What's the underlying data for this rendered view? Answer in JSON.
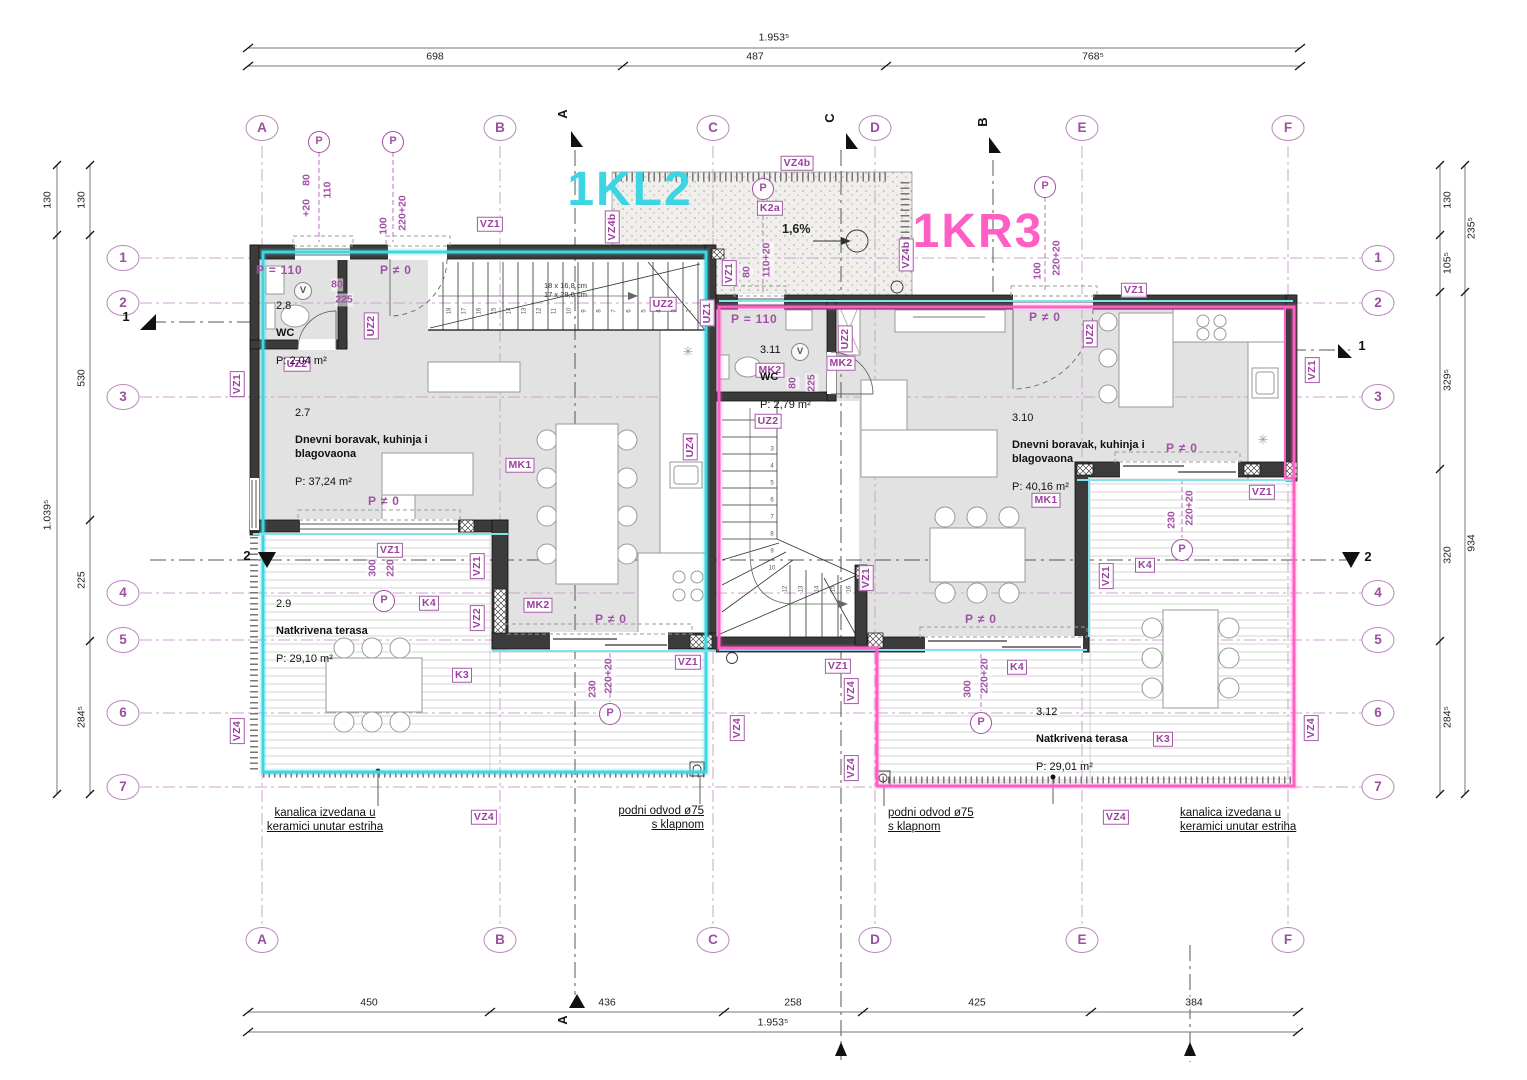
{
  "plan": {
    "width": 1527,
    "height": 1080,
    "drawing_type": "floor plan"
  },
  "colors": {
    "unit_left": "#3dd5e2",
    "unit_right": "#ff5ec5",
    "annotation_purple": "#9b3f9e",
    "grid_purple": "#cda3d2"
  },
  "units": [
    {
      "t": "1KL2",
      "x": 630,
      "y": 190,
      "c": "#3dd5e2",
      "n": "unit-label-1KL2"
    },
    {
      "t": "1KR3",
      "x": 978,
      "y": 232,
      "c": "#ff5ec5",
      "n": "unit-label-1KR3"
    }
  ],
  "bubbles": [
    {
      "t": "A",
      "x": 262,
      "y": 128
    },
    {
      "t": "B",
      "x": 500,
      "y": 128
    },
    {
      "t": "C",
      "x": 713,
      "y": 128
    },
    {
      "t": "D",
      "x": 875,
      "y": 128
    },
    {
      "t": "E",
      "x": 1082,
      "y": 128
    },
    {
      "t": "F",
      "x": 1288,
      "y": 128
    },
    {
      "t": "A",
      "x": 262,
      "y": 940
    },
    {
      "t": "B",
      "x": 500,
      "y": 940
    },
    {
      "t": "C",
      "x": 713,
      "y": 940
    },
    {
      "t": "D",
      "x": 875,
      "y": 940
    },
    {
      "t": "E",
      "x": 1082,
      "y": 940
    },
    {
      "t": "F",
      "x": 1288,
      "y": 940
    },
    {
      "t": "1",
      "x": 123,
      "y": 258
    },
    {
      "t": "2",
      "x": 123,
      "y": 303
    },
    {
      "t": "3",
      "x": 123,
      "y": 397
    },
    {
      "t": "4",
      "x": 123,
      "y": 593
    },
    {
      "t": "5",
      "x": 123,
      "y": 640
    },
    {
      "t": "6",
      "x": 123,
      "y": 713
    },
    {
      "t": "7",
      "x": 123,
      "y": 787
    },
    {
      "t": "1",
      "x": 1378,
      "y": 258
    },
    {
      "t": "2",
      "x": 1378,
      "y": 303
    },
    {
      "t": "3",
      "x": 1378,
      "y": 397
    },
    {
      "t": "4",
      "x": 1378,
      "y": 593
    },
    {
      "t": "5",
      "x": 1378,
      "y": 640
    },
    {
      "t": "6",
      "x": 1378,
      "y": 713
    },
    {
      "t": "7",
      "x": 1378,
      "y": 787
    }
  ],
  "dim_texts": [
    {
      "t": "1.953⁵",
      "x": 774,
      "y": 38
    },
    {
      "t": "698",
      "x": 435,
      "y": 57
    },
    {
      "t": "487",
      "x": 755,
      "y": 57
    },
    {
      "t": "768⁵",
      "x": 1093,
      "y": 57
    },
    {
      "t": "450",
      "x": 369,
      "y": 1003
    },
    {
      "t": "436",
      "x": 607,
      "y": 1003
    },
    {
      "t": "258",
      "x": 793,
      "y": 1003
    },
    {
      "t": "425",
      "x": 977,
      "y": 1003
    },
    {
      "t": "384",
      "x": 1194,
      "y": 1003
    },
    {
      "t": "1.953⁵",
      "x": 773,
      "y": 1023
    },
    {
      "t": "130",
      "x": 48,
      "y": 200,
      "v": 1
    },
    {
      "t": "130",
      "x": 82,
      "y": 200,
      "v": 1
    },
    {
      "t": "530",
      "x": 82,
      "y": 378,
      "v": 1
    },
    {
      "t": "225",
      "x": 82,
      "y": 580,
      "v": 1
    },
    {
      "t": "284⁵",
      "x": 82,
      "y": 717,
      "v": 1
    },
    {
      "t": "1.039⁵",
      "x": 48,
      "y": 515,
      "v": 1
    },
    {
      "t": "130",
      "x": 1448,
      "y": 200,
      "v": 1
    },
    {
      "t": "235⁵",
      "x": 1472,
      "y": 228,
      "v": 1
    },
    {
      "t": "105⁵",
      "x": 1448,
      "y": 263,
      "v": 1
    },
    {
      "t": "329⁵",
      "x": 1448,
      "y": 380,
      "v": 1
    },
    {
      "t": "320",
      "x": 1448,
      "y": 555,
      "v": 1
    },
    {
      "t": "934",
      "x": 1472,
      "y": 543,
      "v": 1
    },
    {
      "t": "284⁵",
      "x": 1448,
      "y": 717,
      "v": 1
    }
  ],
  "tags": [
    {
      "t": "VZ1",
      "x": 490,
      "y": 224
    },
    {
      "t": "VZ1",
      "x": 729,
      "y": 273,
      "v": 1
    },
    {
      "t": "VZ1",
      "x": 237,
      "y": 384,
      "v": 1
    },
    {
      "t": "VZ1",
      "x": 390,
      "y": 550
    },
    {
      "t": "VZ1",
      "x": 477,
      "y": 566,
      "v": 1
    },
    {
      "t": "VZ1",
      "x": 688,
      "y": 662
    },
    {
      "t": "VZ1",
      "x": 838,
      "y": 666
    },
    {
      "t": "VZ1",
      "x": 866,
      "y": 578,
      "v": 1
    },
    {
      "t": "VZ1",
      "x": 1106,
      "y": 576,
      "v": 1
    },
    {
      "t": "VZ1",
      "x": 1134,
      "y": 290
    },
    {
      "t": "VZ1",
      "x": 1262,
      "y": 492
    },
    {
      "t": "VZ1",
      "x": 1312,
      "y": 370,
      "v": 1
    },
    {
      "t": "VZ2",
      "x": 477,
      "y": 618,
      "v": 1
    },
    {
      "t": "VZ4",
      "x": 237,
      "y": 731,
      "v": 1
    },
    {
      "t": "VZ4",
      "x": 484,
      "y": 817
    },
    {
      "t": "VZ4",
      "x": 737,
      "y": 728,
      "v": 1
    },
    {
      "t": "VZ4",
      "x": 851,
      "y": 691,
      "v": 1
    },
    {
      "t": "VZ4",
      "x": 851,
      "y": 768,
      "v": 1
    },
    {
      "t": "VZ4",
      "x": 1116,
      "y": 817
    },
    {
      "t": "VZ4",
      "x": 1311,
      "y": 728,
      "v": 1
    },
    {
      "t": "VZ4b",
      "x": 612,
      "y": 227,
      "v": 1
    },
    {
      "t": "VZ4b",
      "x": 797,
      "y": 163
    },
    {
      "t": "VZ4b",
      "x": 906,
      "y": 255,
      "v": 1
    },
    {
      "t": "UZ1",
      "x": 707,
      "y": 313,
      "v": 1
    },
    {
      "t": "UZ2",
      "x": 297,
      "y": 364
    },
    {
      "t": "UZ2",
      "x": 371,
      "y": 326,
      "v": 1
    },
    {
      "t": "UZ2",
      "x": 663,
      "y": 304
    },
    {
      "t": "UZ2",
      "x": 768,
      "y": 421
    },
    {
      "t": "UZ2",
      "x": 845,
      "y": 339,
      "v": 1
    },
    {
      "t": "UZ2",
      "x": 1090,
      "y": 334,
      "v": 1
    },
    {
      "t": "UZ4",
      "x": 690,
      "y": 447,
      "v": 1
    },
    {
      "t": "MK1",
      "x": 520,
      "y": 465
    },
    {
      "t": "MK1",
      "x": 1046,
      "y": 500
    },
    {
      "t": "MK2",
      "x": 538,
      "y": 605
    },
    {
      "t": "MK2",
      "x": 770,
      "y": 370
    },
    {
      "t": "MK2",
      "x": 841,
      "y": 363
    },
    {
      "t": "K2a",
      "x": 770,
      "y": 208
    },
    {
      "t": "K3",
      "x": 462,
      "y": 675
    },
    {
      "t": "K3",
      "x": 1163,
      "y": 739
    },
    {
      "t": "K4",
      "x": 429,
      "y": 603
    },
    {
      "t": "K4",
      "x": 1017,
      "y": 667
    },
    {
      "t": "K4",
      "x": 1145,
      "y": 565
    }
  ],
  "dim_labels": [
    {
      "t": "80",
      "x": 307,
      "y": 180,
      "v": 1
    },
    {
      "t": "+20",
      "x": 307,
      "y": 208,
      "v": 1
    },
    {
      "t": "110",
      "x": 328,
      "y": 190,
      "v": 1
    },
    {
      "t": "100",
      "x": 384,
      "y": 226,
      "v": 1
    },
    {
      "t": "220+20",
      "x": 403,
      "y": 213,
      "v": 1
    },
    {
      "t": "80",
      "x": 747,
      "y": 272,
      "v": 1
    },
    {
      "t": "110+20",
      "x": 767,
      "y": 260,
      "v": 1
    },
    {
      "t": "100",
      "x": 1038,
      "y": 271,
      "v": 1
    },
    {
      "t": "220+20",
      "x": 1057,
      "y": 258,
      "v": 1
    },
    {
      "t": "80",
      "x": 337,
      "y": 285
    },
    {
      "t": "225",
      "x": 344,
      "y": 300
    },
    {
      "t": "80",
      "x": 793,
      "y": 383,
      "v": 1
    },
    {
      "t": "225",
      "x": 812,
      "y": 383,
      "v": 1
    },
    {
      "t": "300",
      "x": 373,
      "y": 568,
      "v": 1
    },
    {
      "t": "220",
      "x": 391,
      "y": 568,
      "v": 1
    },
    {
      "t": "230",
      "x": 593,
      "y": 689,
      "v": 1
    },
    {
      "t": "220+20",
      "x": 609,
      "y": 676,
      "v": 1
    },
    {
      "t": "300",
      "x": 968,
      "y": 689,
      "v": 1
    },
    {
      "t": "220+20",
      "x": 985,
      "y": 676,
      "v": 1
    },
    {
      "t": "230",
      "x": 1172,
      "y": 520,
      "v": 1
    },
    {
      "t": "220+20",
      "x": 1190,
      "y": 508,
      "v": 1
    }
  ],
  "p_texts": [
    {
      "t": "P = 110",
      "x": 256,
      "y": 263
    },
    {
      "t": "P ≠ 0",
      "x": 380,
      "y": 263
    },
    {
      "t": "P = 110",
      "x": 731,
      "y": 312
    },
    {
      "t": "P ≠ 0",
      "x": 1029,
      "y": 310
    },
    {
      "t": "P ≠ 0",
      "x": 368,
      "y": 494
    },
    {
      "t": "P ≠ 0",
      "x": 595,
      "y": 612
    },
    {
      "t": "P ≠ 0",
      "x": 965,
      "y": 612
    },
    {
      "t": "P ≠ 0",
      "x": 1166,
      "y": 441
    }
  ],
  "rooms": [
    {
      "id": "2.8",
      "name": "WC",
      "area": "P: 2,04 m²",
      "x": 276,
      "y": 286
    },
    {
      "id": "2.7",
      "name": "Dnevni boravak, kuhinja i blagovaona",
      "area": "P: 37,24 m²",
      "x": 295,
      "y": 393,
      "w": 150
    },
    {
      "id": "2.9",
      "name": "Natkrivena terasa",
      "area": "P: 29,10 m²",
      "x": 276,
      "y": 584
    },
    {
      "id": "3.10",
      "name": "Dnevni boravak, kuhinja i blagovaona",
      "area": "P: 40,16 m²",
      "x": 1012,
      "y": 398,
      "w": 150
    },
    {
      "id": "3.11",
      "name": "WC",
      "area": "P: 2,79 m²",
      "x": 760,
      "y": 330
    },
    {
      "id": "3.12",
      "name": "Natkrivena terasa",
      "area": "P: 29,01 m²",
      "x": 1036,
      "y": 692
    }
  ],
  "notes": [
    {
      "t": "kanalica izvedana u\nkeramici unutar estriha",
      "x": 325,
      "y": 806,
      "cls": "tc u"
    },
    {
      "t": "podni odvod ø75\ns klapnom",
      "x": 704,
      "y": 804,
      "cls": "tr u"
    },
    {
      "t": "podni odvod ø75\ns klapnom",
      "x": 888,
      "y": 806,
      "cls": "tl u"
    },
    {
      "t": "kanalica izvedana u\nkeramici unutar estriha",
      "x": 1180,
      "y": 806,
      "cls": "tl u"
    },
    {
      "t": "1,6%",
      "x": 782,
      "y": 222,
      "cls": "tl slope"
    },
    {
      "t": "18 x 16,8 cm\n17 x 28,0 cm",
      "x": 544,
      "y": 281,
      "cls": "tl stairnote"
    }
  ],
  "markers": [
    {
      "t": "A",
      "x": 563,
      "y": 114,
      "v": 1
    },
    {
      "t": "C",
      "x": 830,
      "y": 118,
      "v": 1
    },
    {
      "t": "B",
      "x": 983,
      "y": 122,
      "v": 1
    },
    {
      "t": "A",
      "x": 563,
      "y": 1020,
      "v": 1
    },
    {
      "t": "1",
      "x": 126,
      "y": 317
    },
    {
      "t": "1",
      "x": 1362,
      "y": 346
    },
    {
      "t": "2",
      "x": 247,
      "y": 556
    },
    {
      "t": "2",
      "x": 1368,
      "y": 557
    }
  ],
  "circles": [
    {
      "t": "P",
      "x": 319,
      "y": 142
    },
    {
      "t": "P",
      "x": 393,
      "y": 142
    },
    {
      "t": "P",
      "x": 763,
      "y": 189
    },
    {
      "t": "P",
      "x": 1045,
      "y": 187
    },
    {
      "t": "P",
      "x": 384,
      "y": 601
    },
    {
      "t": "P",
      "x": 610,
      "y": 714
    },
    {
      "t": "P",
      "x": 981,
      "y": 723
    },
    {
      "t": "P",
      "x": 1182,
      "y": 550
    },
    {
      "t": "V",
      "x": 303,
      "y": 291,
      "cls": "vc"
    },
    {
      "t": "V",
      "x": 800,
      "y": 352,
      "cls": "vc"
    }
  ],
  "symbols": [
    {
      "t": "✳",
      "x": 688,
      "y": 352,
      "n": "appliance-snowflake-icon"
    },
    {
      "t": "✳",
      "x": 1263,
      "y": 440,
      "n": "appliance-snowflake-icon"
    }
  ],
  "stair_numbers": [
    {
      "t": "18",
      "x": 450,
      "y": 311,
      "v": 1
    },
    {
      "t": "17",
      "x": 465,
      "y": 311,
      "v": 1
    },
    {
      "t": "16",
      "x": 480,
      "y": 311,
      "v": 1
    },
    {
      "t": "15",
      "x": 495,
      "y": 311,
      "v": 1
    },
    {
      "t": "14",
      "x": 510,
      "y": 311,
      "v": 1
    },
    {
      "t": "13",
      "x": 525,
      "y": 311,
      "v": 1
    },
    {
      "t": "12",
      "x": 540,
      "y": 311,
      "v": 1
    },
    {
      "t": "11",
      "x": 555,
      "y": 311,
      "v": 1
    },
    {
      "t": "10",
      "x": 570,
      "y": 311,
      "v": 1
    },
    {
      "t": "9",
      "x": 585,
      "y": 311,
      "v": 1
    },
    {
      "t": "8",
      "x": 600,
      "y": 311,
      "v": 1
    },
    {
      "t": "7",
      "x": 615,
      "y": 311,
      "v": 1
    },
    {
      "t": "6",
      "x": 630,
      "y": 311,
      "v": 1
    },
    {
      "t": "5",
      "x": 645,
      "y": 311,
      "v": 1
    },
    {
      "t": "4",
      "x": 660,
      "y": 311,
      "v": 1
    },
    {
      "t": "3",
      "x": 675,
      "y": 311,
      "v": 1
    },
    {
      "t": "2",
      "x": 690,
      "y": 311,
      "v": 1
    },
    {
      "t": "3",
      "x": 772,
      "y": 450
    },
    {
      "t": "4",
      "x": 772,
      "y": 467
    },
    {
      "t": "5",
      "x": 772,
      "y": 484
    },
    {
      "t": "6",
      "x": 772,
      "y": 501
    },
    {
      "t": "7",
      "x": 772,
      "y": 518
    },
    {
      "t": "8",
      "x": 772,
      "y": 535
    },
    {
      "t": "9",
      "x": 772,
      "y": 552
    },
    {
      "t": "10",
      "x": 772,
      "y": 569
    },
    {
      "t": "12",
      "x": 786,
      "y": 589,
      "v": 1
    },
    {
      "t": "13",
      "x": 802,
      "y": 589,
      "v": 1
    },
    {
      "t": "14",
      "x": 818,
      "y": 589,
      "v": 1
    },
    {
      "t": "15",
      "x": 834,
      "y": 589,
      "v": 1
    },
    {
      "t": "16",
      "x": 850,
      "y": 589,
      "v": 1
    }
  ]
}
